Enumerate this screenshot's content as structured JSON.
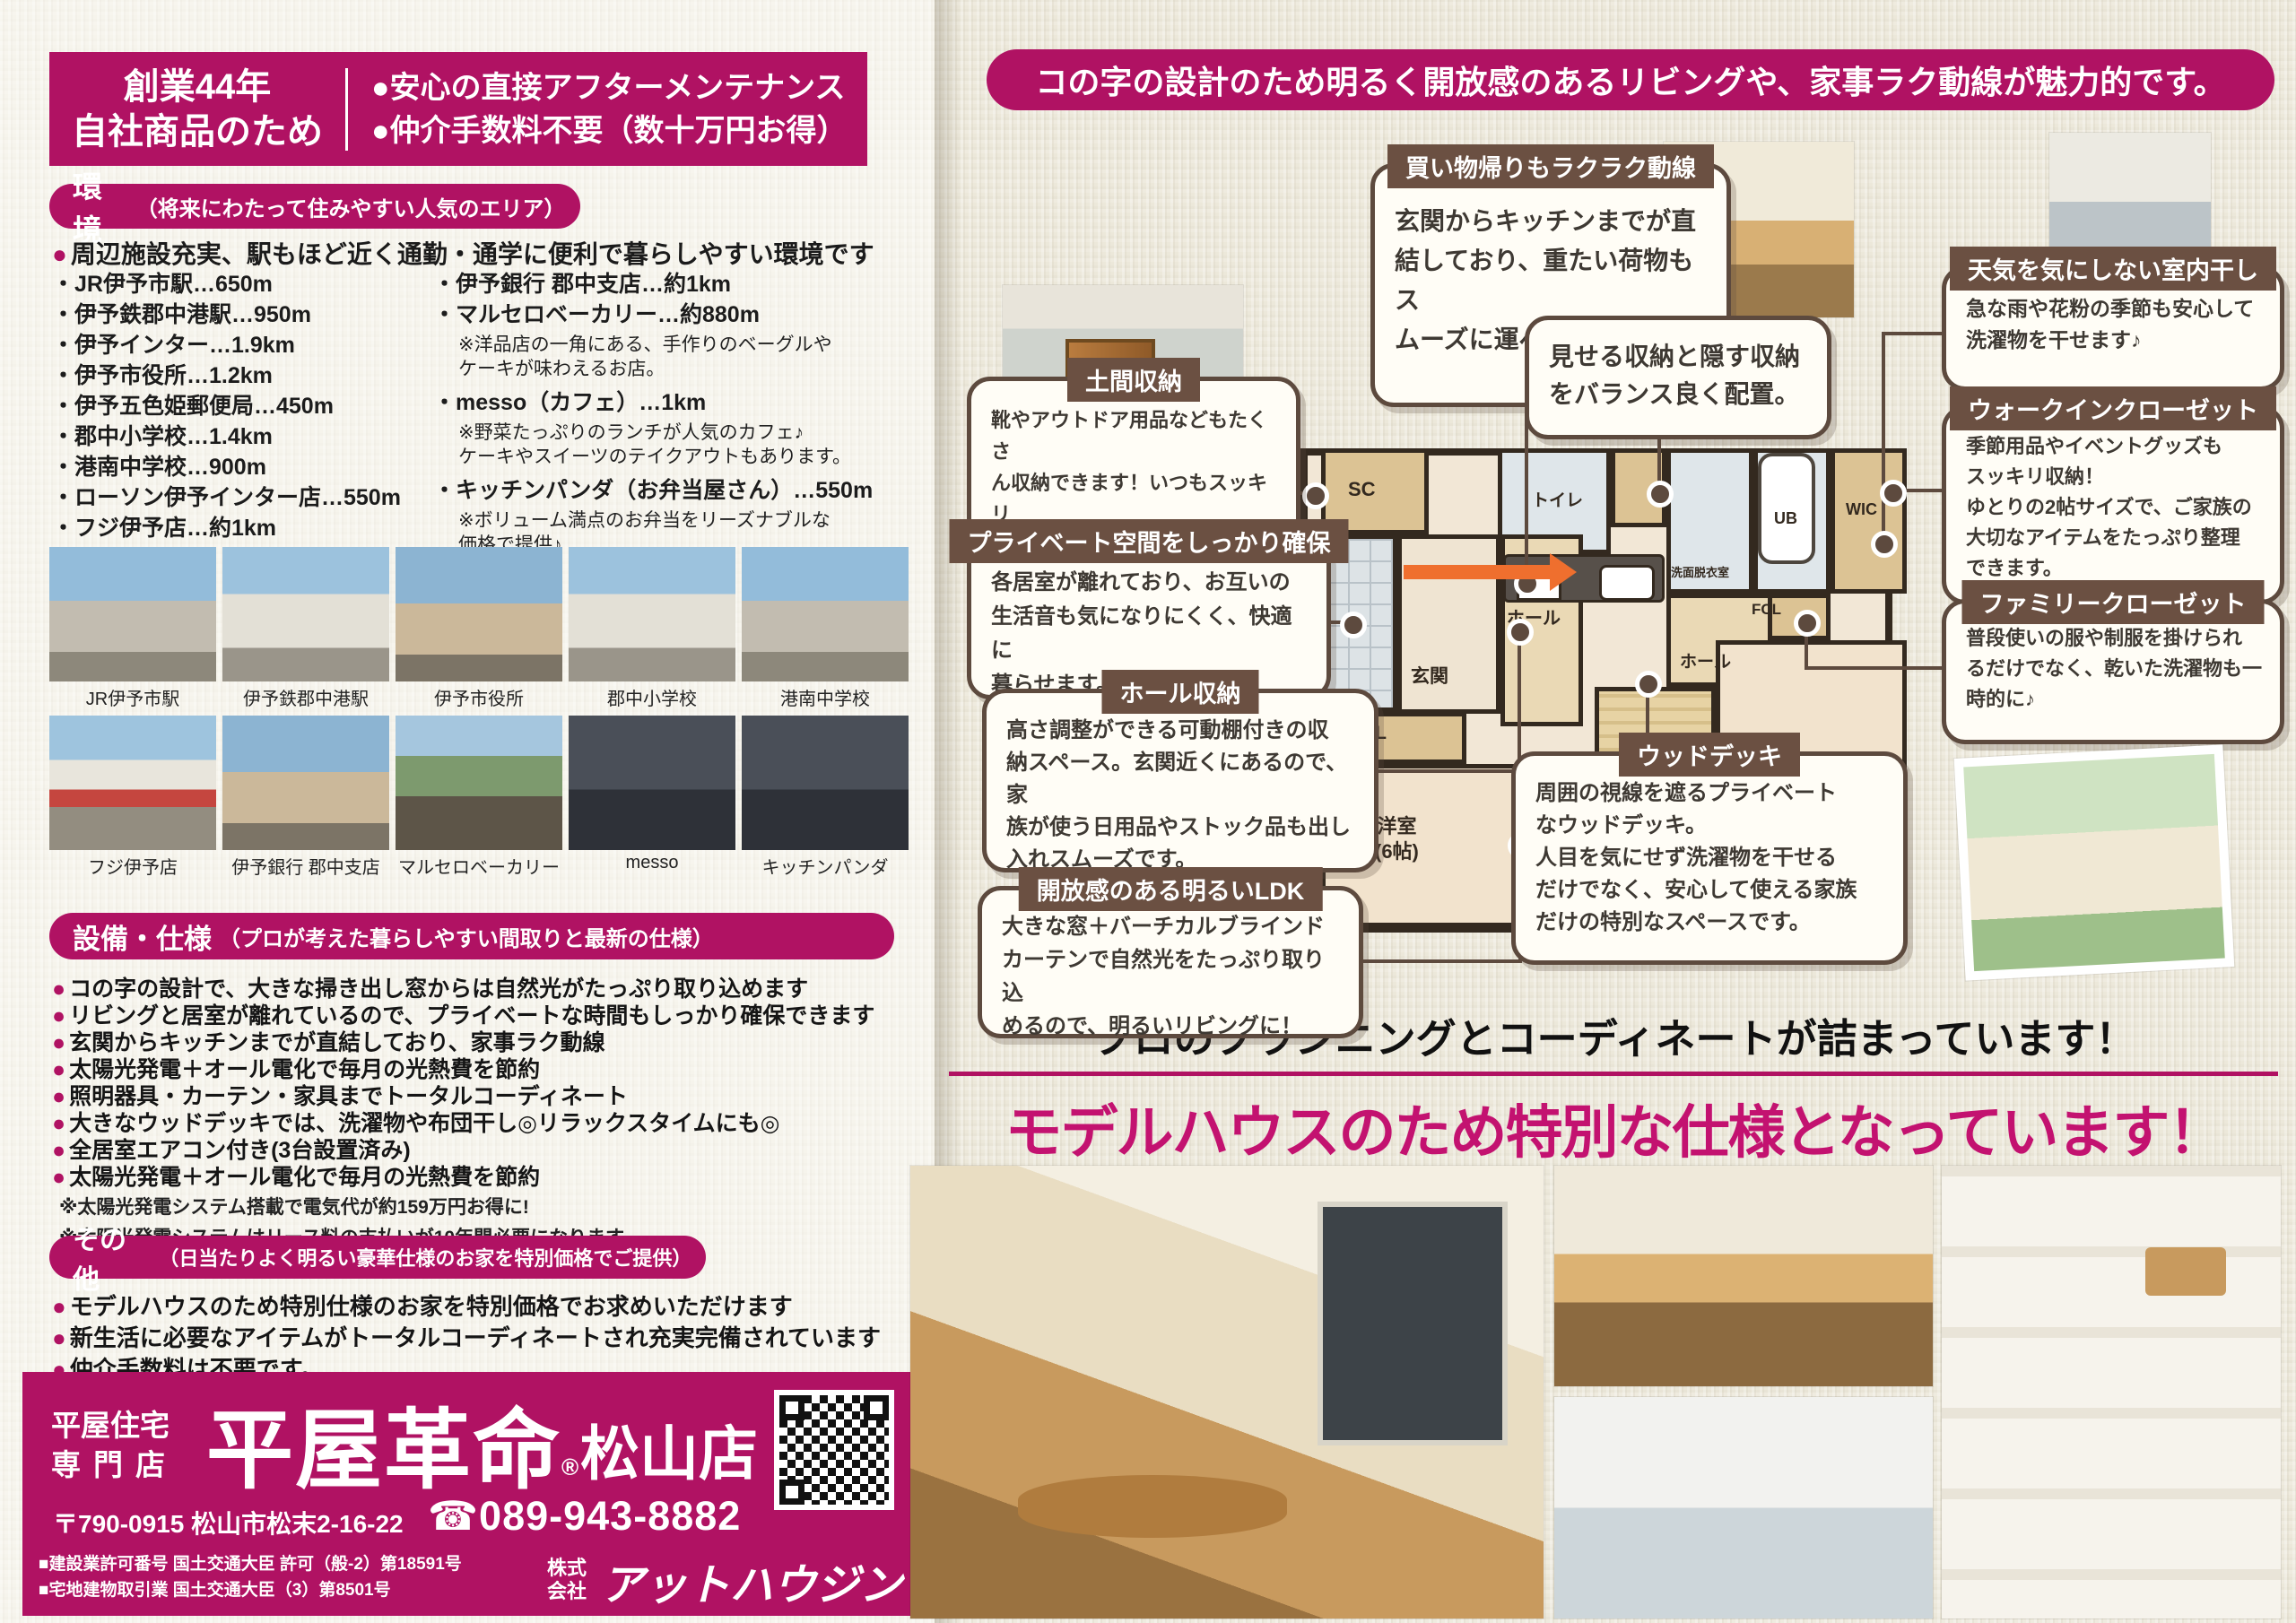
{
  "glyphs": {
    "dot": "●"
  },
  "colors": {
    "magenta": "#b01263",
    "headline_magenta": "#c31270",
    "brown": "#5d4a3e",
    "title_brown": "#6b5042",
    "arrow_orange": "#ef6f2e",
    "background": "#ece8da"
  },
  "left": {
    "header": {
      "line1": "創業44年",
      "line2": "自社商品のため",
      "bullet1": "●安心の直接アフターメンテナンス",
      "bullet2": "●仲介手数料不要（数十万円お得）"
    },
    "env": {
      "title": "環境",
      "subtitle": "（将来にわたって住みやすい人気のエリア）",
      "lead": "周辺施設充実、駅もほど近く通勤・通学に便利で暮らしやすい環境です",
      "left_items": [
        "・JR伊予市駅…650m",
        "・伊予鉄郡中港駅…950m",
        "・伊予インター…1.9km",
        "・伊予市役所…1.2km",
        "・伊予五色姫郵便局…450m",
        "・郡中小学校…1.4km",
        "・港南中学校…900m",
        "・ローソン伊予インター店…550m",
        "・フジ伊予店…約1km"
      ],
      "right_items": [
        {
          "text": "・伊予銀行 郡中支店…約1km"
        },
        {
          "text": "・マルセロベーカリー…約880m"
        },
        {
          "text": "※洋品店の一角にある、手作りのベーグルや\nケーキが味わえるお店。"
        },
        {
          "text": "・messo（カフェ）…1km"
        },
        {
          "text": "※野菜たっぷりのランチが人気のカフェ♪\nケーキやスイーツのテイクアウトもあります。"
        },
        {
          "text": "・キッチンパンダ（お弁当屋さん）…550m"
        },
        {
          "text": "※ボリューム満点のお弁当をリーズナブルな\n価格で提供♪"
        }
      ]
    },
    "photos_row1": [
      "JR伊予市駅",
      "伊予鉄郡中港駅",
      "伊予市役所",
      "郡中小学校",
      "港南中学校"
    ],
    "photos_row2": [
      "フジ伊予店",
      "伊予銀行 郡中支店",
      "マルセロベーカリー",
      "messo",
      "キッチンパンダ"
    ],
    "spec": {
      "title": "設備・仕様",
      "subtitle": "（プロが考えた暮らしやすい間取りと最新の仕様）",
      "items": [
        "コの字の設計で、大きな掃き出し窓からは自然光がたっぷり取り込めます",
        "リビングと居室が離れているので、プライベートな時間もしっかり確保できます",
        "玄関からキッチンまでが直結しており、家事ラク動線",
        "太陽光発電＋オール電化で毎月の光熱費を節約",
        "照明器具・カーテン・家具までトータルコーディネート",
        "大きなウッドデッキでは、洗濯物や布団干し◎リラックスタイムにも◎",
        "全居室エアコン付き(3台設置済み)",
        "太陽光発電＋オール電化で毎月の光熱費を節約"
      ],
      "notes": [
        "※太陽光発電システム搭載で電気代が約159万円お得に!",
        "※太陽光発電システムはリース料の支払いが10年間必要になります"
      ]
    },
    "other": {
      "title": "その他",
      "subtitle": "（日当たりよく明るい豪華仕様のお家を特別価格でご提供）",
      "items": [
        "モデルハウスのため特別仕様のお家を特別価格でお求めいただけます",
        "新生活に必要なアイテムがトータルコーディネートされ充実完備されています",
        "仲介手数料は不要です。"
      ]
    },
    "footer": {
      "tag1": "平屋住宅",
      "tag2": "専門店",
      "brand": "平屋革命",
      "brand_reg": "®",
      "branch": "松山店",
      "address": "〒790-0915 松山市松末2-16-22",
      "tel": "☎089-943-8882",
      "license1": "■建設業許可番号 国土交通大臣 許可（般-2）第18591号",
      "license2": "■宅地建物取引業 国土交通大臣（3）第8501号",
      "company_prefix1": "株式",
      "company_prefix2": "会社",
      "company": "アットハウジング"
    }
  },
  "right": {
    "banner": "コの字の設計のため明るく開放感のあるリビングや、家事ラク動線が魅力的です。",
    "callouts": {
      "shopping": {
        "title": "買い物帰りもラクラク動線",
        "body": "玄関からキッチンまでが直\n結しており、重たい荷物もス\nムーズに運べます♪"
      },
      "display": {
        "body": "見せる収納と隠す収納\nをバランス良く配置。"
      },
      "weather": {
        "title": "天気を気にしない室内干し",
        "body": "急な雨や花粉の季節も安心して\n洗濯物を干せます♪"
      },
      "doma": {
        "title": "土間収納",
        "body": "靴やアウトドア用品などもたくさ\nん収納できます！いつもスッキリ\nした収納に。"
      },
      "wic": {
        "title": "ウォークインクローゼット",
        "body": "季節用品やイベントグッズも\nスッキリ収納！\nゆとりの2帖サイズで、ご家族の\n大切なアイテムをたっぷり整理\nできます。"
      },
      "private": {
        "title": "プライベート空間をしっかり確保",
        "body": "各居室が離れており、お互いの\n生活音も気になりにくく、快適に\n暮らせます。"
      },
      "hall": {
        "title": "ホール収納",
        "body": "高さ調整ができる可動棚付きの収\n納スペース。玄関近くにあるので、家\n族が使う日用品やストック品も出し\n入れスムーズです。"
      },
      "family": {
        "title": "ファミリークローゼット",
        "body": "普段使いの服や制服を掛けられ\nるだけでなく、乾いた洗濯物も一\n時的に♪"
      },
      "ldk": {
        "title": "開放感のある明るいLDK",
        "body": "大きな窓＋バーチカルブラインド\nカーテンで自然光をたっぷり取り込\nめるので、明るいリビングに！"
      },
      "deck": {
        "title": "ウッドデッキ",
        "body": "周囲の視線を遮るプライベート\nなウッドデッキ。\n人目を気にせず洗濯物を干せる\nだけでなく、安心して使える家族\nだけの特別なスペースです。"
      }
    },
    "plan": {
      "sc": "SC",
      "toilet": "トイレ",
      "genkan": "玄関",
      "hall1": "ホール",
      "cl": "CL",
      "room1": "洋室\n(6帖)",
      "ldk": "LDK\n（14帖）",
      "hall2": "ホール",
      "senmen": "洗面脱衣室",
      "ub": "UB",
      "wic": "WIC",
      "fcl": "FCL",
      "deck": "ウッドデッキ",
      "room2": "洋室\n(6帖)"
    },
    "tagline": "プロのプランニングとコーディネートが詰まっています！",
    "headline": "モデルハウスのため特別な仕様となっています！"
  }
}
